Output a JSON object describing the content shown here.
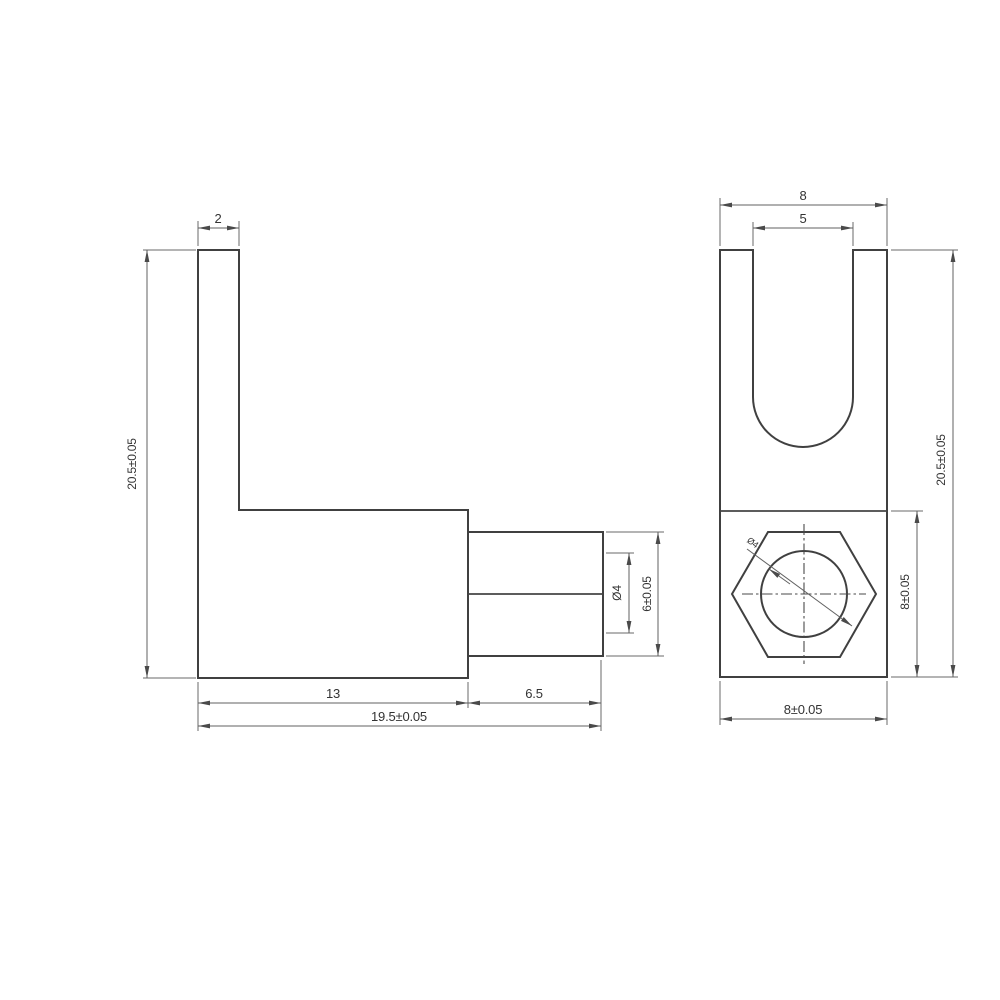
{
  "drawing": {
    "colors": {
      "background": "#ffffff",
      "outline": "#404040",
      "dimension_lines": "#616161",
      "text": "#333333"
    },
    "front_view": {
      "dims": {
        "arm_width": "2",
        "overall_height": "20.5±0.05",
        "body_length": "13",
        "boss_length": "6.5",
        "overall_length": "19.5±0.05",
        "hole_dia": "Ø4",
        "boss_dia": "6±0.05"
      }
    },
    "side_view": {
      "dims": {
        "overall_width": "8",
        "slot_width": "5",
        "overall_height": "20.5±0.05",
        "base_height": "8±0.05",
        "base_width": "8±0.05",
        "hole_dia": "Ø4"
      }
    }
  }
}
